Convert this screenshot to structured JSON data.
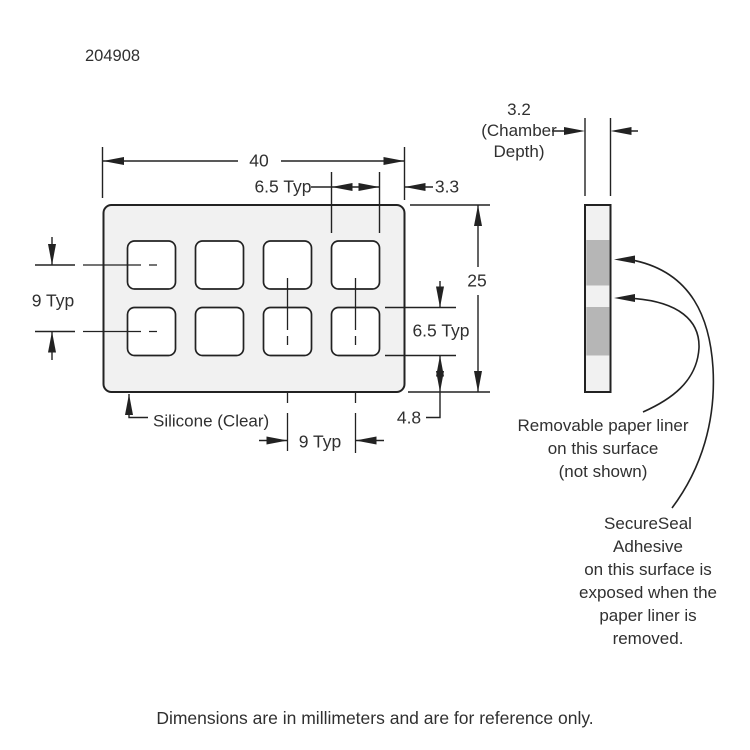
{
  "title_block": {
    "part_number": "204908"
  },
  "footer": {
    "note": "Dimensions are in millimeters and are for reference only."
  },
  "front_view": {
    "material_label": "Silicone (Clear)",
    "chamber_rows": 2,
    "chamber_columns": 4,
    "dimensions": {
      "overall_width": "40",
      "overall_height": "25",
      "chamber_width": "6.5 Typ",
      "chamber_height": "6.5 Typ",
      "row_pitch": "9 Typ",
      "column_pitch": "9 Typ",
      "right_margin": "3.3",
      "bottom_margin": "4.8"
    }
  },
  "side_view": {
    "chamber_depth": {
      "value": "3.2",
      "label_line2": "(Chamber",
      "label_line3": "Depth)"
    },
    "liner_note": {
      "line1": "Removable paper liner",
      "line2": "on this surface",
      "line3": "(not shown)"
    },
    "adhesive_note": {
      "line1": "SecureSeal",
      "line2": "Adhesive",
      "line3": "on this surface is",
      "line4": "exposed when the",
      "line5": "paper liner is",
      "line6": "removed."
    }
  },
  "colors": {
    "line": "#222222",
    "text": "#303030",
    "body-fill": "#f1f1f1",
    "chamber-fill": "#ffffff",
    "band-fill": "#b6b6b6",
    "background": "#ffffff"
  }
}
